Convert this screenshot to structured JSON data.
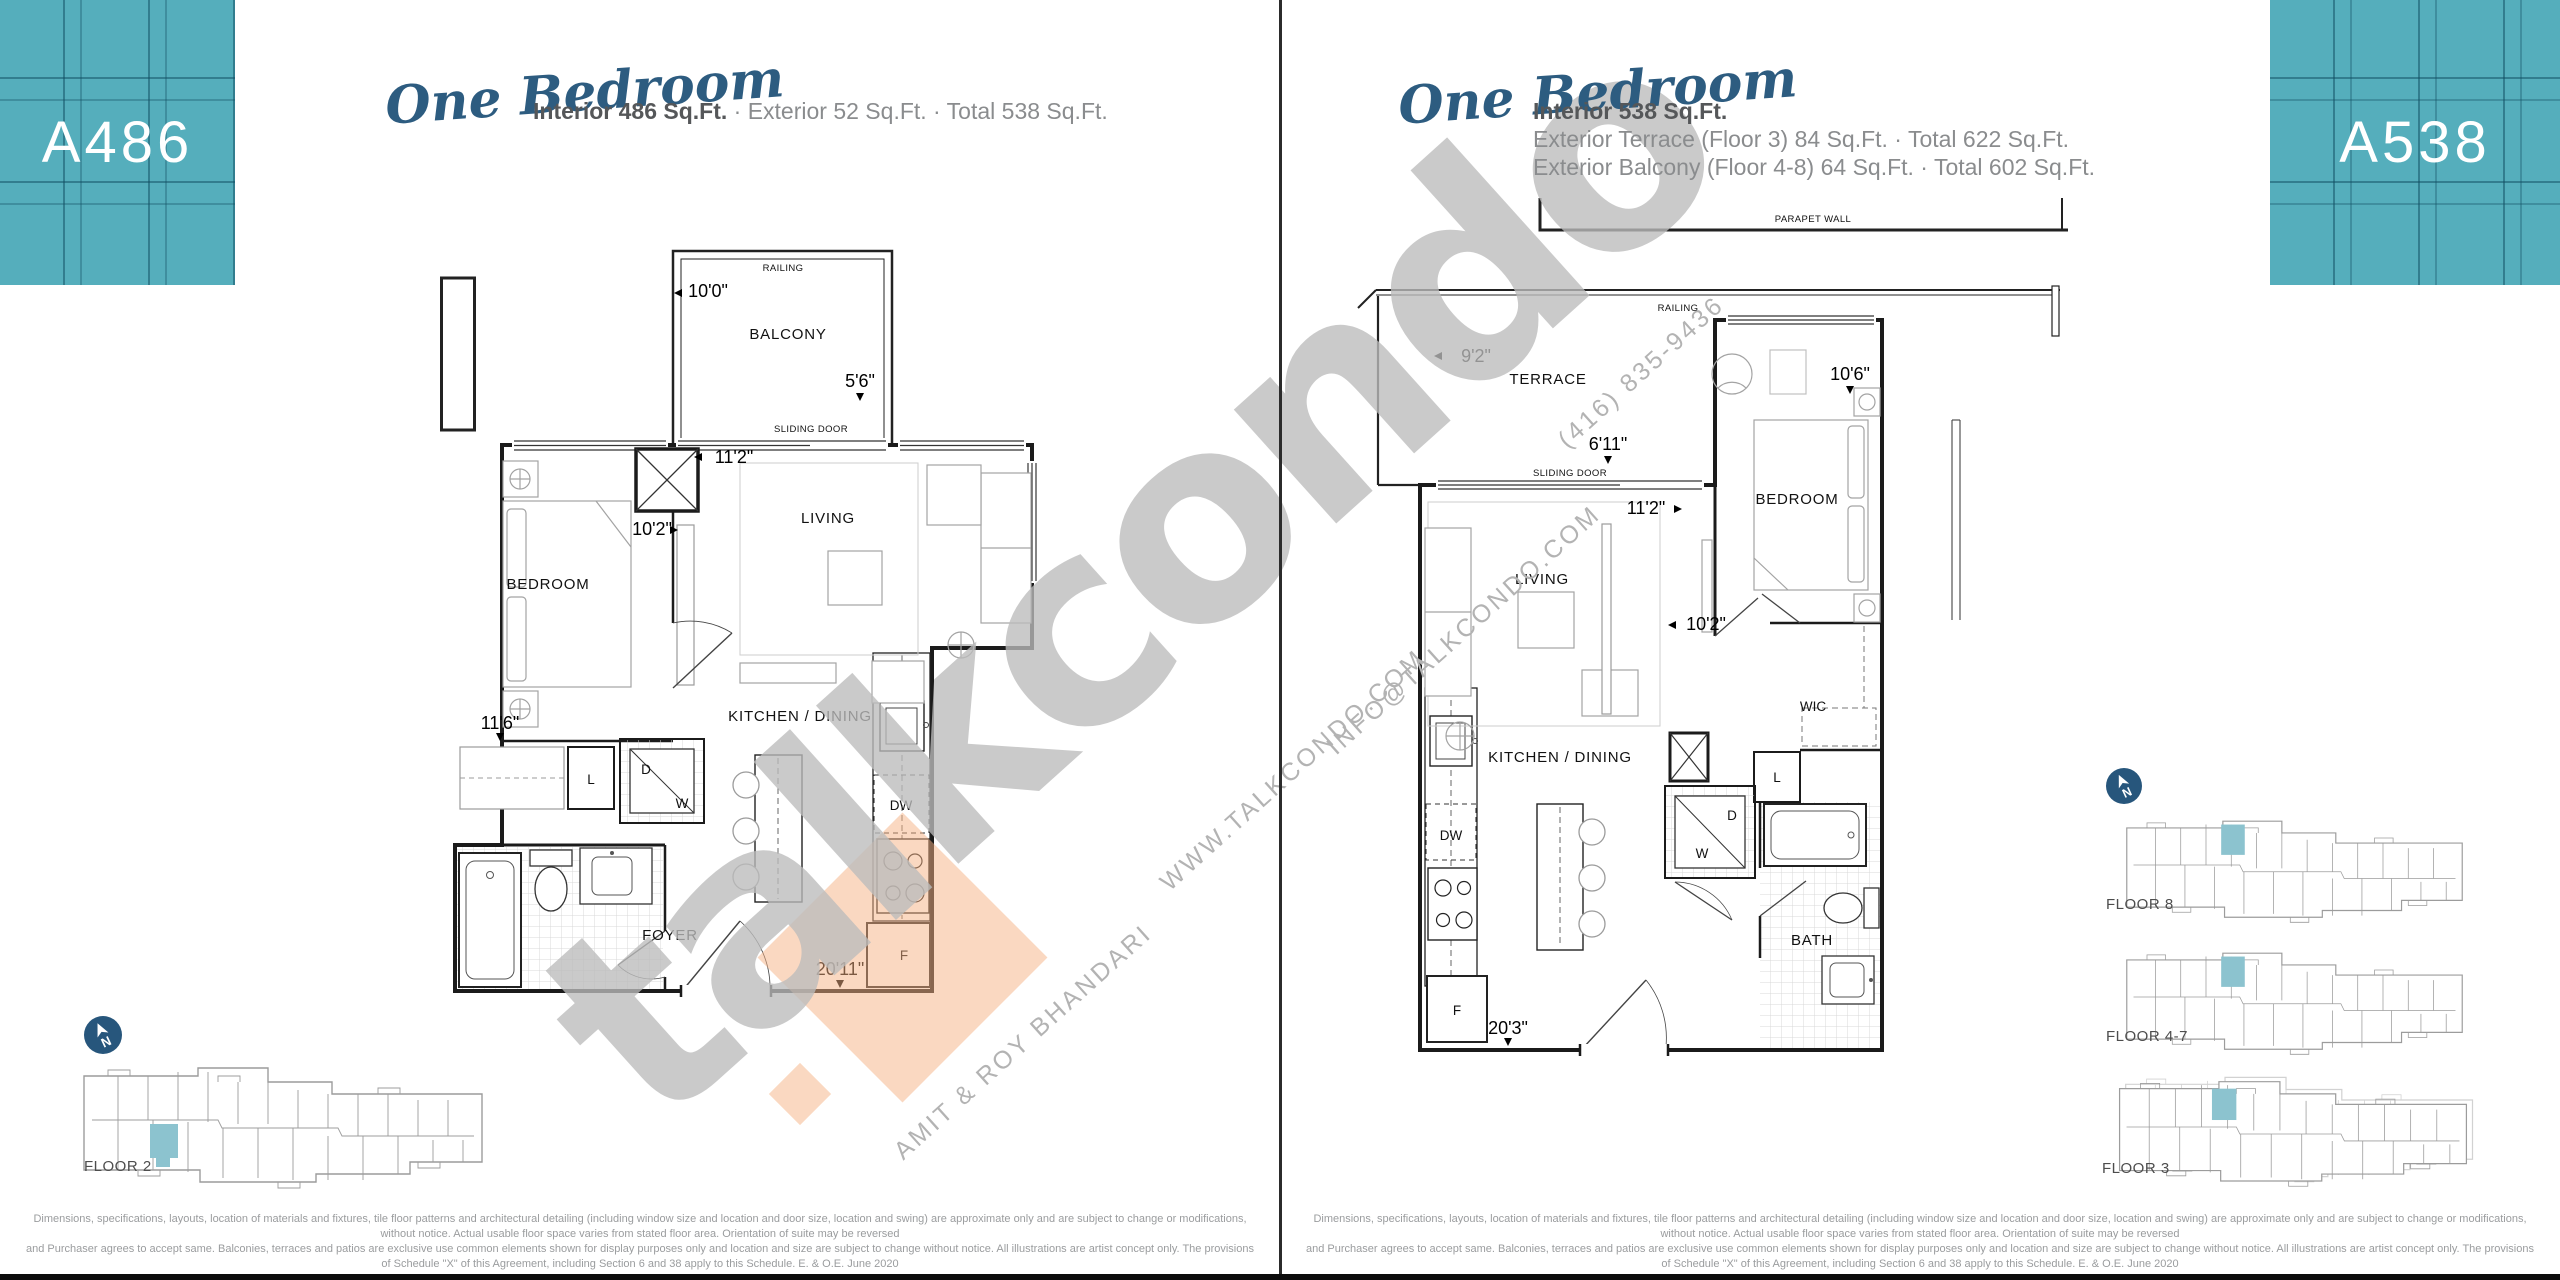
{
  "left_panel": {
    "unit_code": "A486",
    "plan_type": "One Bedroom",
    "stats": {
      "interior": "Interior 486 Sq.Ft.",
      "rest": " · Exterior 52 Sq.Ft. ·  Total 538 Sq.Ft."
    },
    "floor_plan": {
      "rooms": {
        "balcony": "BALCONY",
        "bedroom": "BEDROOM",
        "living": "LIVING",
        "kitchen": "KITCHEN / DINING",
        "foyer": "FOYER"
      },
      "features": {
        "railing": "RAILING",
        "sliding_door": "SLIDING DOOR",
        "linen": "L",
        "dryer": "D",
        "washer": "W",
        "dishwasher": "DW",
        "fridge": "F"
      },
      "dimensions": {
        "balcony_width": "10'0\"",
        "balcony_depth": "5'6\"",
        "living_width": "11'2\"",
        "living_depth": "10'2\"",
        "bedroom_width": "11'6\"",
        "suite_width": "20'11\""
      }
    },
    "locator": {
      "floor": "FLOOR 2"
    }
  },
  "right_panel": {
    "unit_code": "A538",
    "plan_type": "One Bedroom",
    "stats": {
      "interior": "Interior 538 Sq.Ft.",
      "line2": "Exterior Terrace (Floor 3) 84 Sq.Ft. · Total 622 Sq.Ft.",
      "line3": "Exterior Balcony (Floor 4-8) 64 Sq.Ft. · Total 602 Sq.Ft."
    },
    "floor_plan": {
      "rooms": {
        "terrace": "TERRACE",
        "bedroom": "BEDROOM",
        "living": "LIVING",
        "kitchen": "KITCHEN / DINING",
        "wic": "WIC",
        "bath": "BATH"
      },
      "features": {
        "parapet": "PARAPET WALL",
        "railing": "RAILING",
        "sliding_door": "SLIDING DOOR",
        "linen": "L",
        "dryer": "D",
        "washer": "W",
        "dishwasher": "DW",
        "fridge": "F"
      },
      "dimensions": {
        "terrace_width": "9'2\"",
        "terrace_depth": "6'11\"",
        "living_width": "11'2\"",
        "living_depth": "10'2\"",
        "bedroom_width": "10'6\"",
        "suite_width": "20'3\""
      }
    },
    "locators": [
      {
        "floor": "FLOOR 8"
      },
      {
        "floor": "FLOOR 4-7"
      },
      {
        "floor": "FLOOR 3"
      }
    ]
  },
  "watermark": {
    "wordmark": "talkcondo",
    "phone": "(416) 835-9436",
    "website": "WWW.TALKCONDO.COM",
    "email": "INFO@TALKCONDO.COM",
    "agents": "AMIT & ROY BHANDARI"
  },
  "compass": {
    "letter": "N"
  },
  "disclaimer": {
    "line1": "Dimensions, specifications, layouts, location of materials and fixtures, tile floor patterns and architectural detailing (including window size and location and door size, location and swing) are approximate only and are subject to change or modifications, without notice. Actual usable floor space varies from stated floor area. Orientation of suite may be reversed",
    "line2": "and Purchaser agrees to accept same. Balconies, terraces and patios are exclusive use common elements shown for display purposes only and location and size are subject to change without notice. All illustrations are artist concept only. The provisions of Schedule \"X\" of this Agreement, including Section 6 and 38 apply to this Schedule. E. & O.E. June 2020"
  },
  "colors": {
    "teal_block": "#55aebc",
    "navy": "#2d5c80",
    "locator_highlight": "#8cc3cf",
    "watermark_gray": "#bcbcbc",
    "watermark_peach": "#f5b183"
  }
}
